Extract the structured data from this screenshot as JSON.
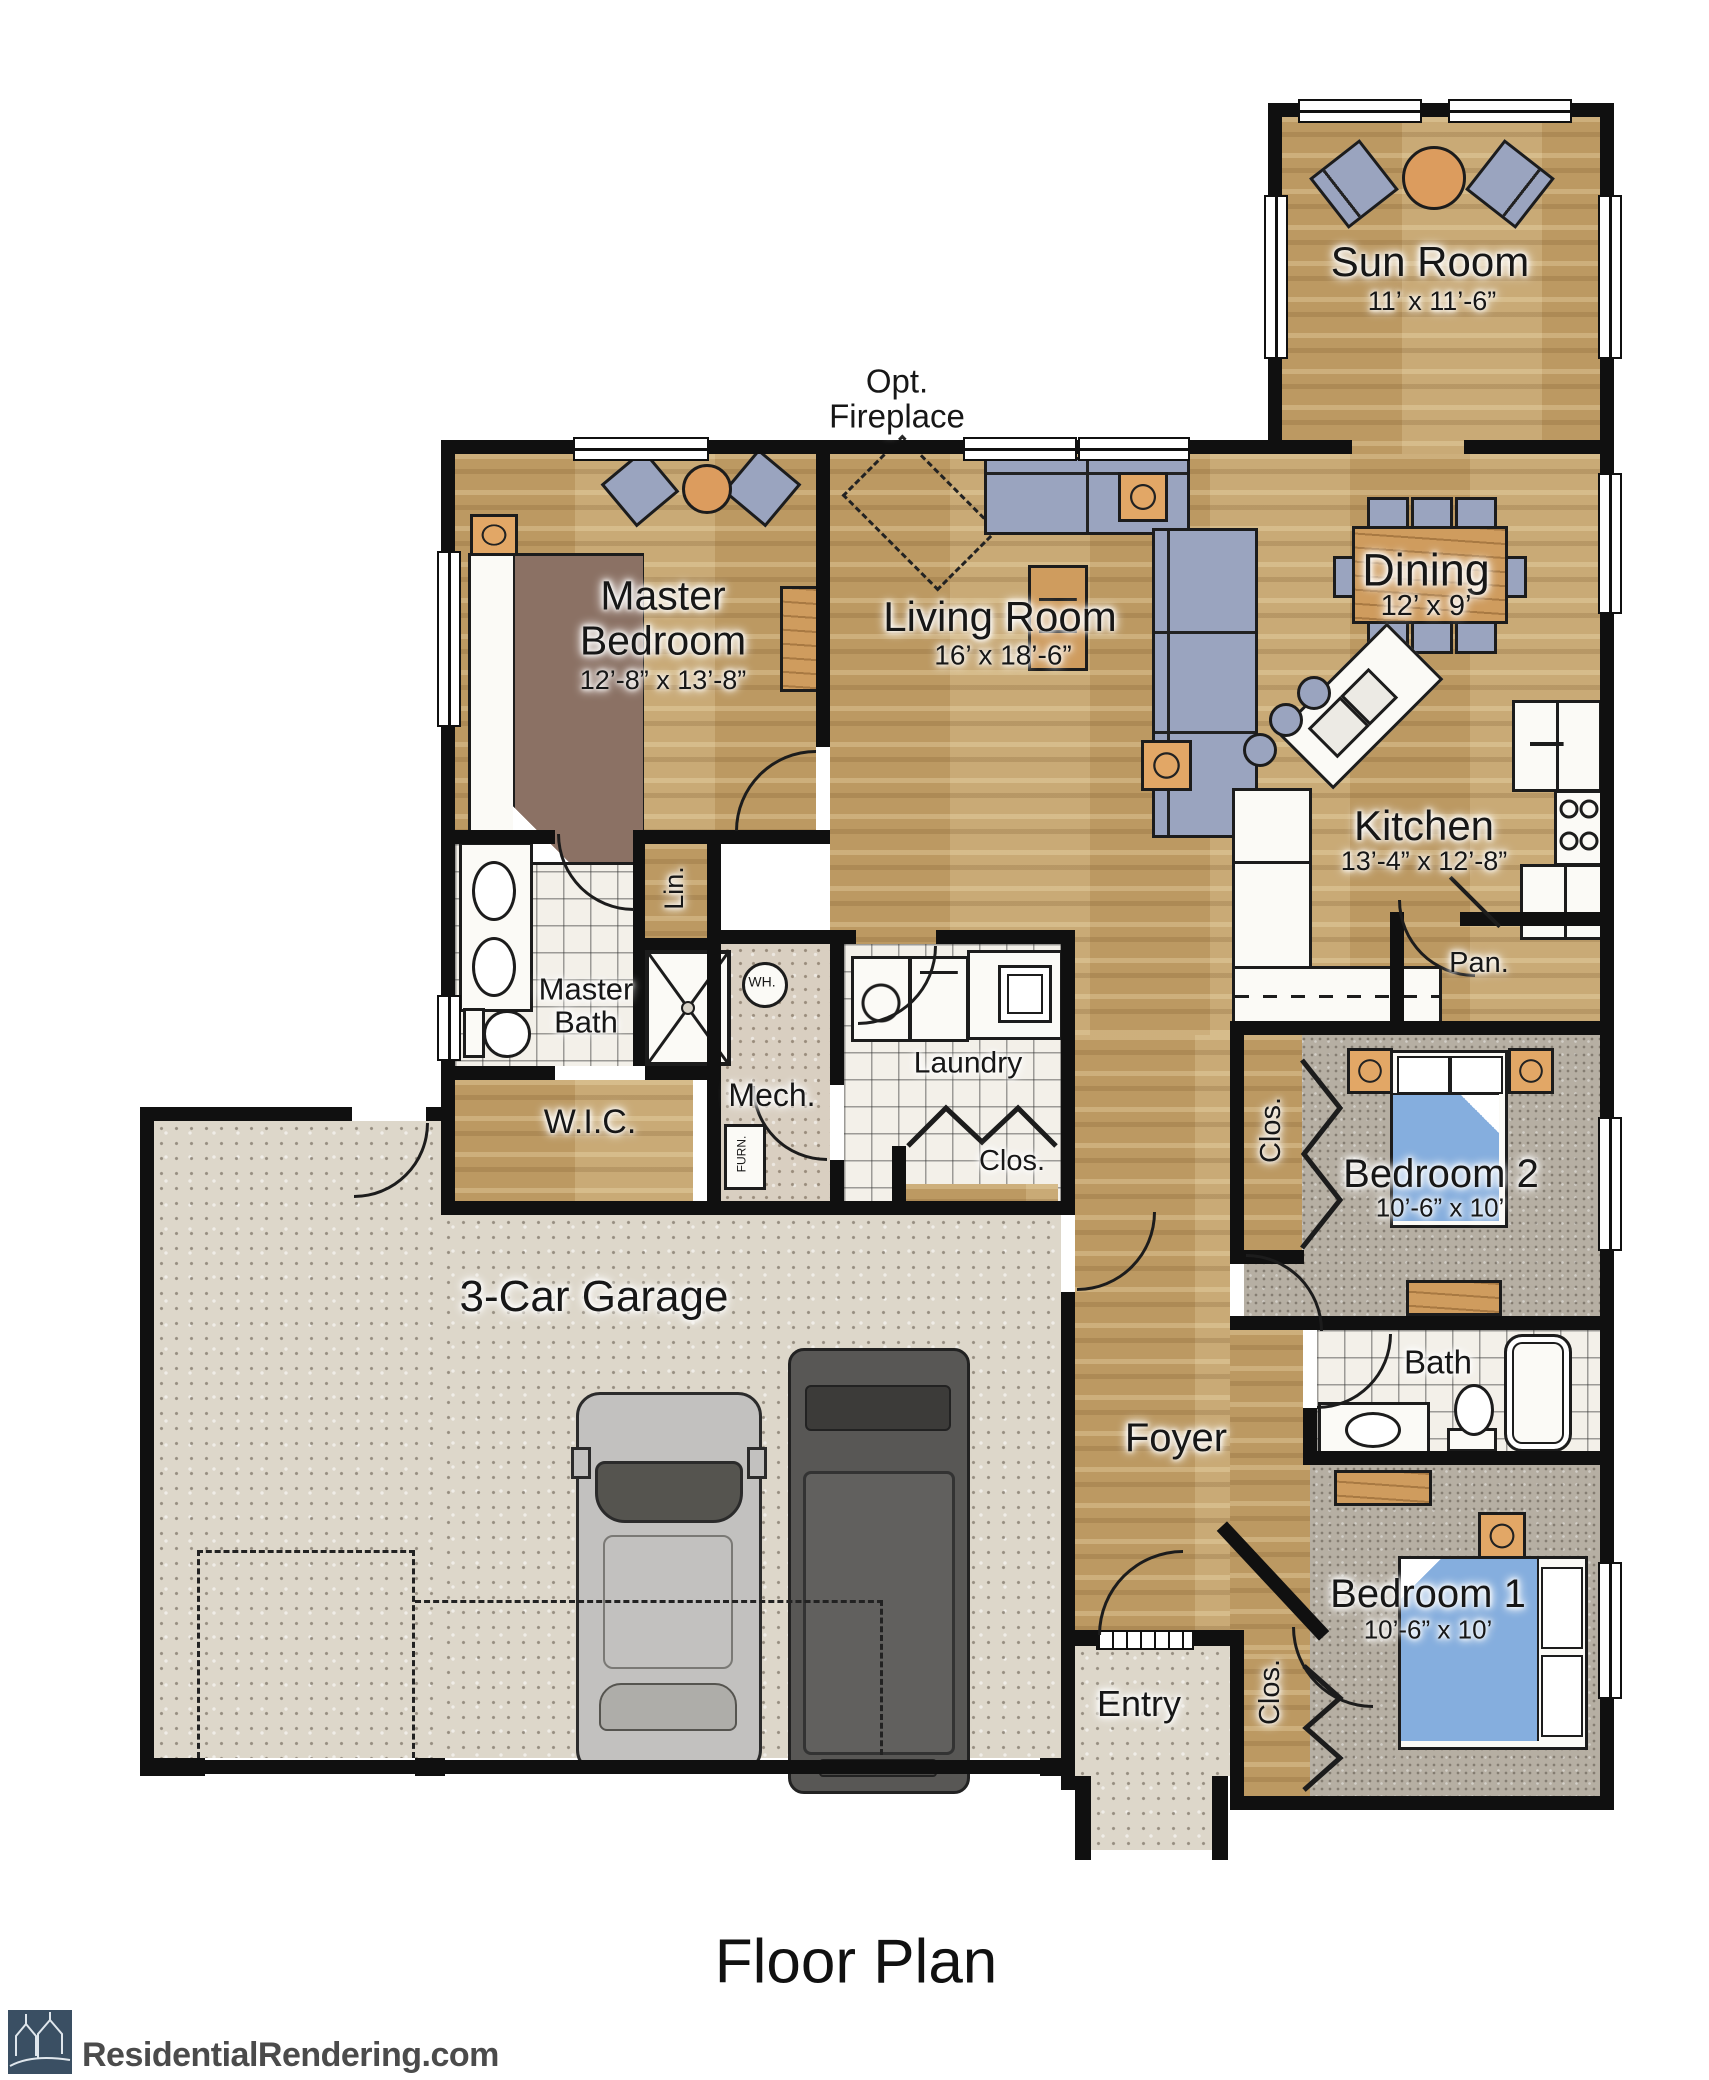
{
  "title": "Floor Plan",
  "branding": {
    "site": "ResidentialRendering.com"
  },
  "annotations": {
    "opt1": "Opt.",
    "opt2": "Fireplace",
    "wh": "WH.",
    "furn": "FURN."
  },
  "rooms": {
    "sun_room": {
      "name": "Sun Room",
      "dims": "11’ x 11’-6”"
    },
    "master_bedroom": {
      "l1": "Master",
      "l2": "Bedroom",
      "dims": "12’-8” x 13’-8”"
    },
    "living_room": {
      "name": "Living Room",
      "dims": "16’ x 18’-6”"
    },
    "dining": {
      "name": "Dining",
      "dims": "12’ x 9’"
    },
    "kitchen": {
      "name": "Kitchen",
      "dims": "13’-4” x 12’-8”"
    },
    "pantry": {
      "name": "Pan."
    },
    "linen": {
      "name": "Lin."
    },
    "master_bath": {
      "l1": "Master",
      "l2": "Bath"
    },
    "wic": {
      "name": "W.I.C."
    },
    "mech": {
      "name": "Mech."
    },
    "laundry": {
      "name": "Laundry"
    },
    "laundry_closet": {
      "name": "Clos."
    },
    "bedroom2": {
      "name": "Bedroom 2",
      "dims": "10’-6” x 10’"
    },
    "bedroom2_closet": {
      "name": "Clos."
    },
    "bath": {
      "name": "Bath"
    },
    "bedroom1": {
      "name": "Bedroom 1",
      "dims": "10’-6” x 10’"
    },
    "bedroom1_closet": {
      "name": "Clos."
    },
    "foyer": {
      "name": "Foyer"
    },
    "entry": {
      "name": "Entry"
    },
    "garage": {
      "name": "3-Car Garage"
    }
  },
  "colors": {
    "wall": "#101010",
    "wood": "#c2a069",
    "carpet": "#b6afa3",
    "tile": "#f3f0e9",
    "concrete": "#ddd7ca",
    "furniture_gray": "#9aa4bf",
    "accent_wood": "#d9a05f",
    "bed_blue": "#85aede",
    "bed_brown": "#8b7164",
    "logo_square": "#3a4f63"
  }
}
